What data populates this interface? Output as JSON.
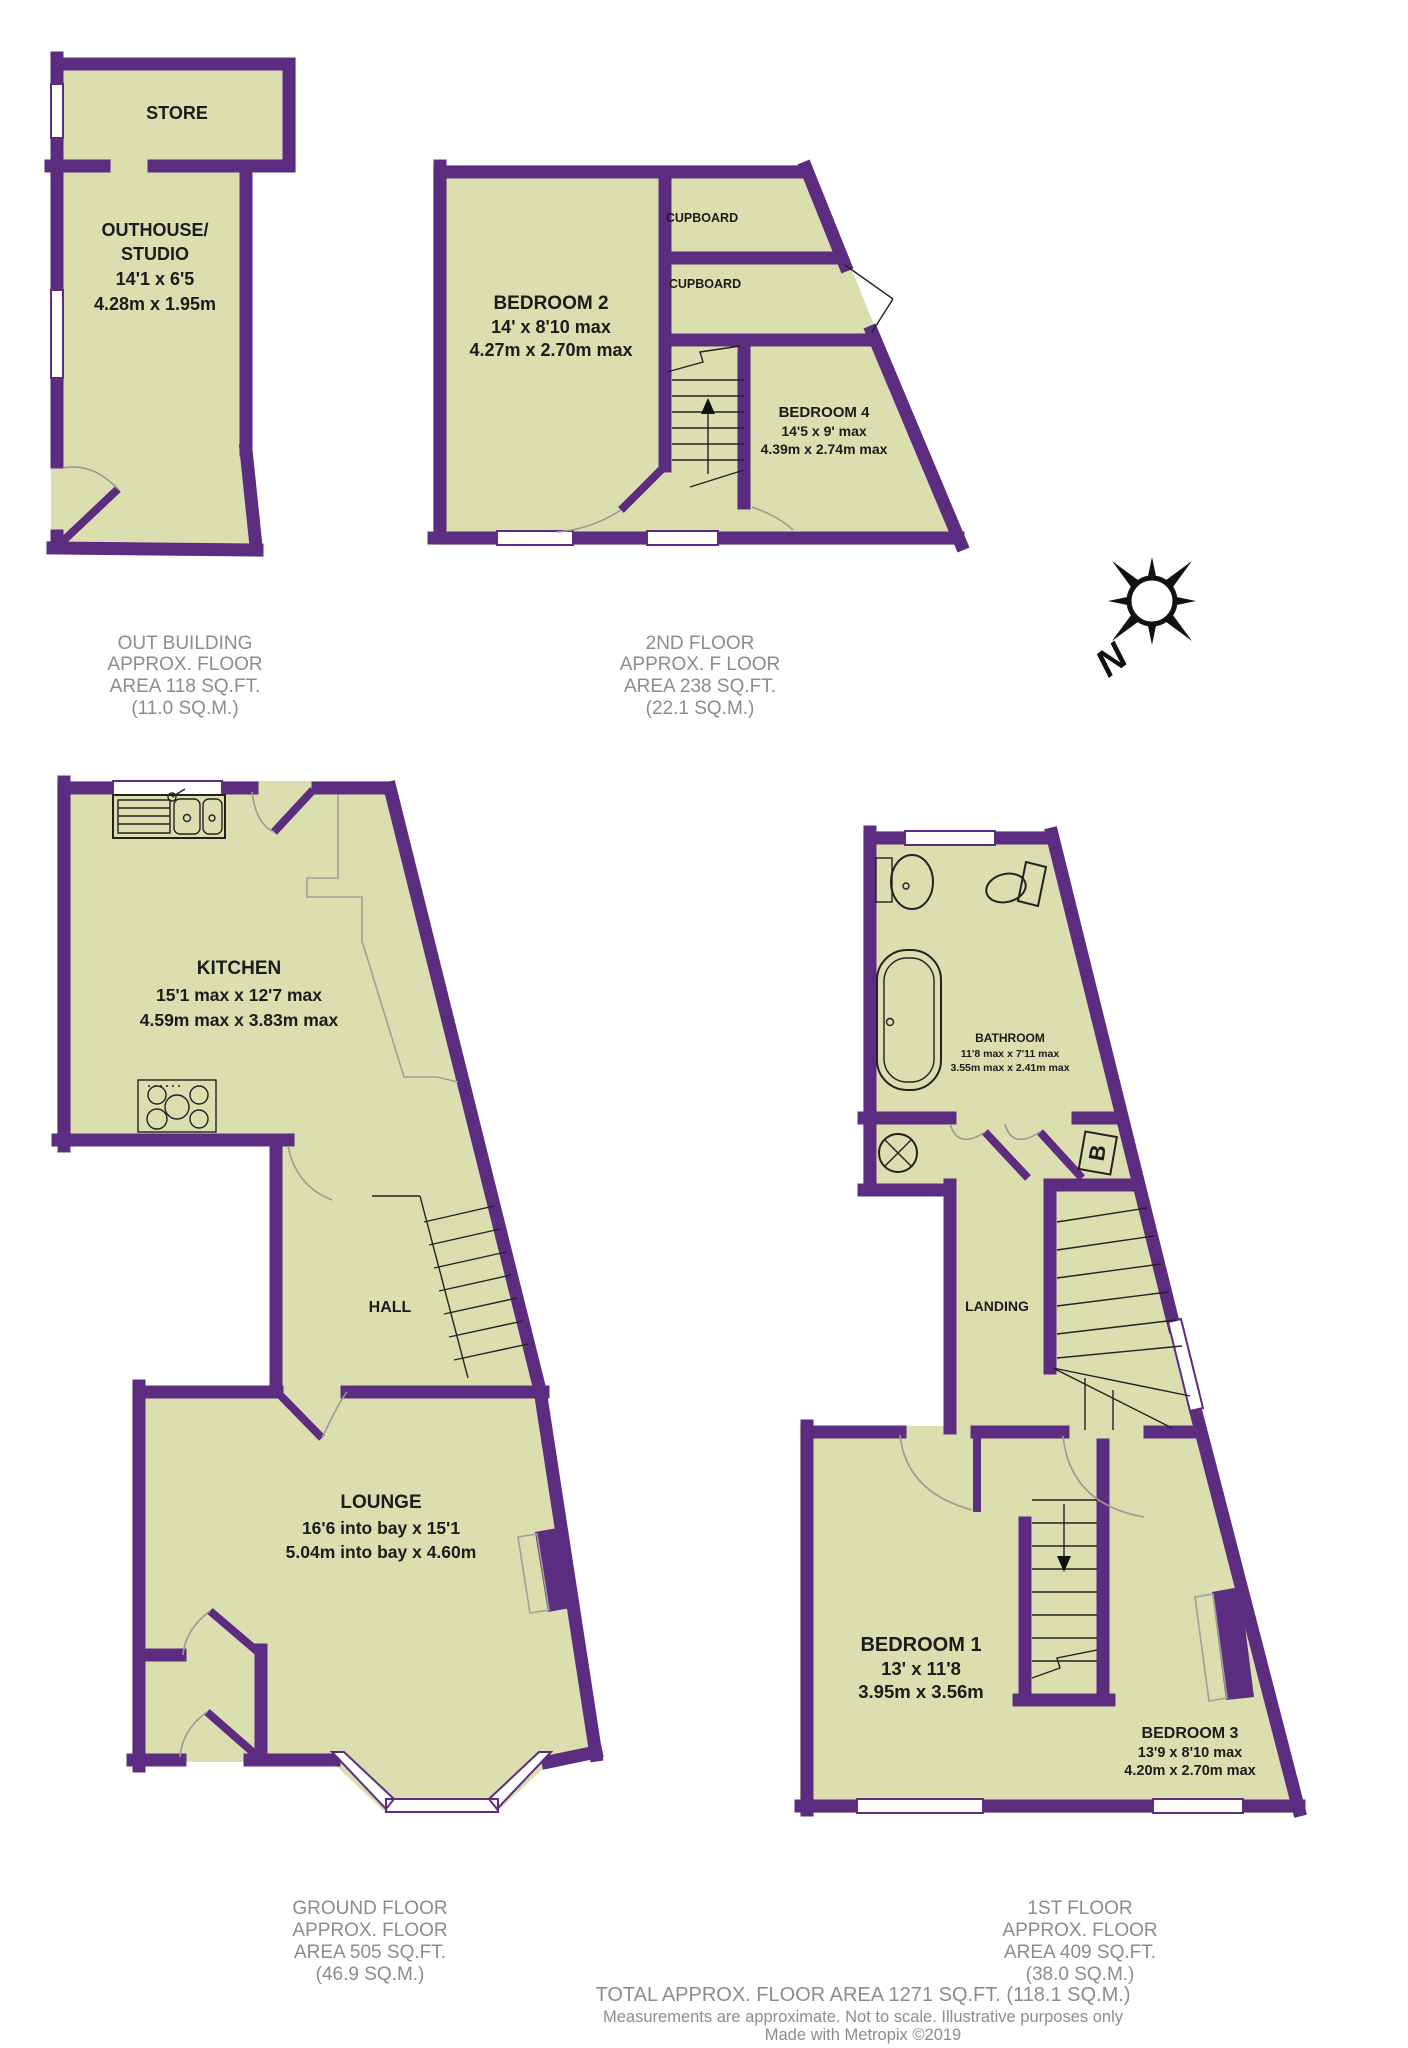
{
  "labels": {
    "store": "STORE",
    "outhouse": [
      "OUTHOUSE/",
      "STUDIO",
      "14'1 x 6'5",
      "4.28m x 1.95m"
    ],
    "bedroom2": [
      "BEDROOM 2",
      "14' x 8'10 max",
      "4.27m x 2.70m max"
    ],
    "cupboard_top": "CUPBOARD",
    "cupboard_mid": "CUPBOARD",
    "bedroom4": [
      "BEDROOM 4",
      "14'5 x 9' max",
      "4.39m x 2.74m max"
    ],
    "kitchen": [
      "KITCHEN",
      "15'1 max x 12'7 max",
      "4.59m max x 3.83m max"
    ],
    "hall": "HALL",
    "lounge": [
      "LOUNGE",
      "16'6 into bay x 15'1",
      "5.04m into bay x 4.60m"
    ],
    "bathroom": [
      "BATHROOM",
      "11'8 max x 7'11 max",
      "3.55m max x 2.41m max"
    ],
    "landing": "LANDING",
    "bedroom1": [
      "BEDROOM 1",
      "13' x 11'8",
      "3.95m x 3.56m"
    ],
    "bedroom3": [
      "BEDROOM 3",
      "13'9 x 8'10 max",
      "4.20m x 2.70m max"
    ],
    "boiler": "B",
    "compass": "N"
  },
  "captions": {
    "outbuilding": [
      "OUT BUILDING",
      "APPROX. FLOOR",
      "AREA 118 SQ.FT.",
      "(11.0 SQ.M.)"
    ],
    "second_floor": [
      "2ND FLOOR",
      "APPROX. F LOOR",
      "AREA 238 SQ.FT.",
      "(22.1 SQ.M.)"
    ],
    "ground_floor": [
      "GROUND FLOOR",
      "APPROX. FLOOR",
      "AREA 505 SQ.FT.",
      "(46.9 SQ.M.)"
    ],
    "first_floor": [
      "1ST FLOOR",
      "APPROX. FLOOR",
      "AREA 409 SQ.FT.",
      "(38.0 SQ.M.)"
    ]
  },
  "footer": {
    "total": "TOTAL APPROX. FLOOR AREA 1271 SQ.FT. (118.1 SQ.M.)",
    "disclaimer": "Measurements are approximate.  Not to scale.  Illustrative purposes only",
    "credit": "Made with Metropix ©2019"
  },
  "colors": {
    "wall": "#5c2c80",
    "floor": "#dbdeae",
    "caption": "#8d8d87"
  }
}
